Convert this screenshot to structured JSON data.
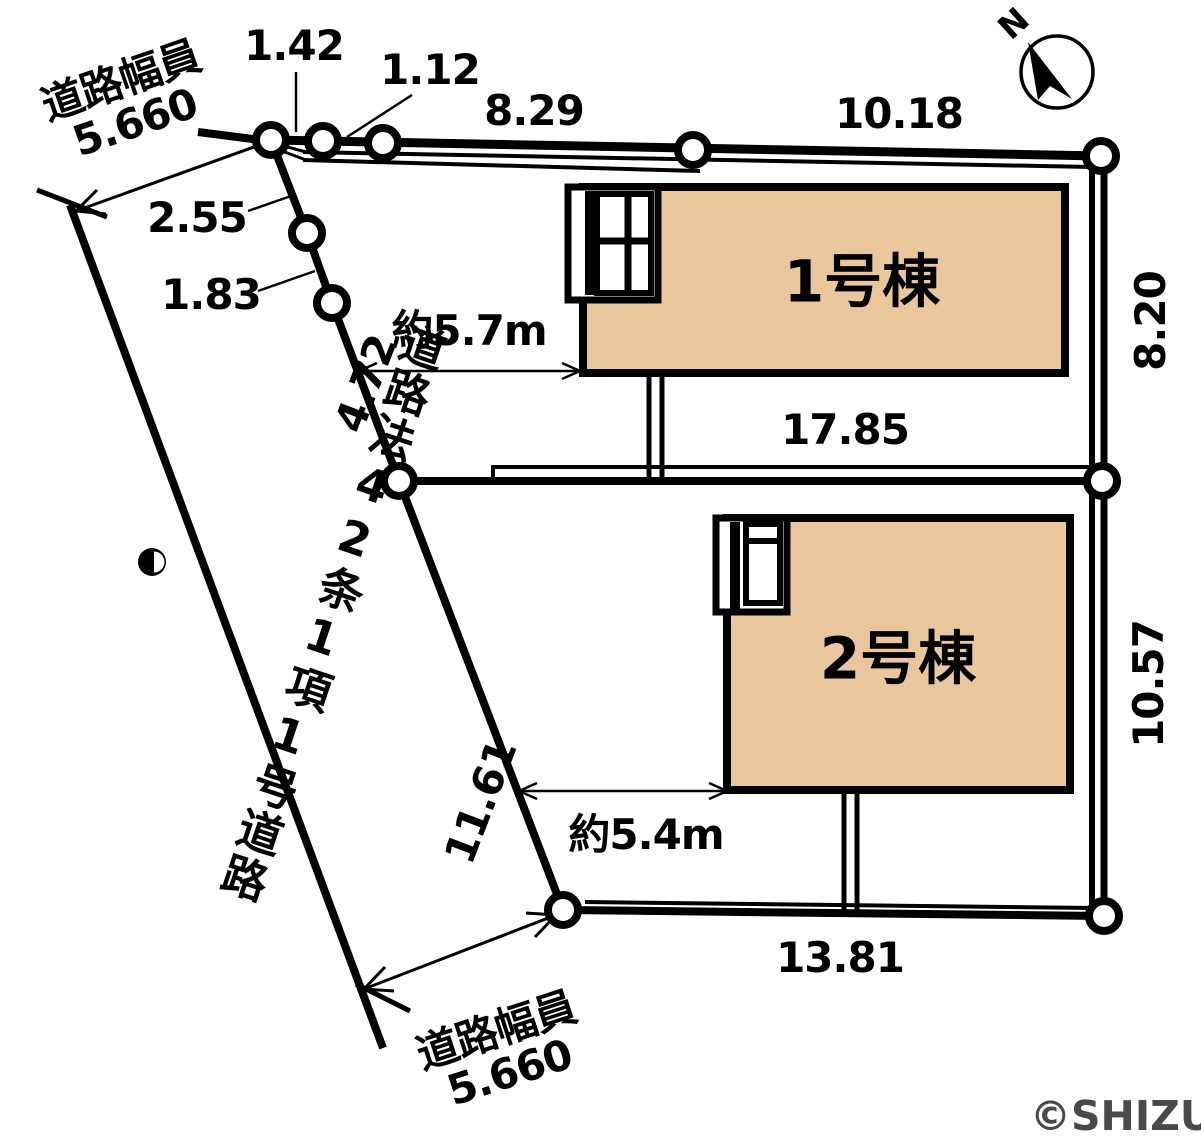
{
  "dims": {
    "d142": "1.42",
    "d112": "1.12",
    "d829": "8.29",
    "d1018": "10.18",
    "d255": "2.55",
    "d183": "1.83",
    "d472": "4.72",
    "d1161": "11.61",
    "d820": "8.20",
    "d1057": "10.57",
    "d1785": "17.85",
    "d1381": "13.81"
  },
  "setbacks": {
    "b1": "約5.7m",
    "b2": "約5.4m"
  },
  "roads": {
    "width_label": "道路幅員",
    "width_value": "5.660",
    "designation": "道路法42条1項1号道路"
  },
  "buildings": {
    "b1": "1号棟",
    "b2": "2号棟"
  },
  "compass": {
    "north": "N"
  },
  "footer": {
    "copyright": "©SHIZUNAVI"
  },
  "colors": {
    "building_fill": "#e9c69c",
    "line": "#000000",
    "copyright": "#4a4a4a"
  }
}
